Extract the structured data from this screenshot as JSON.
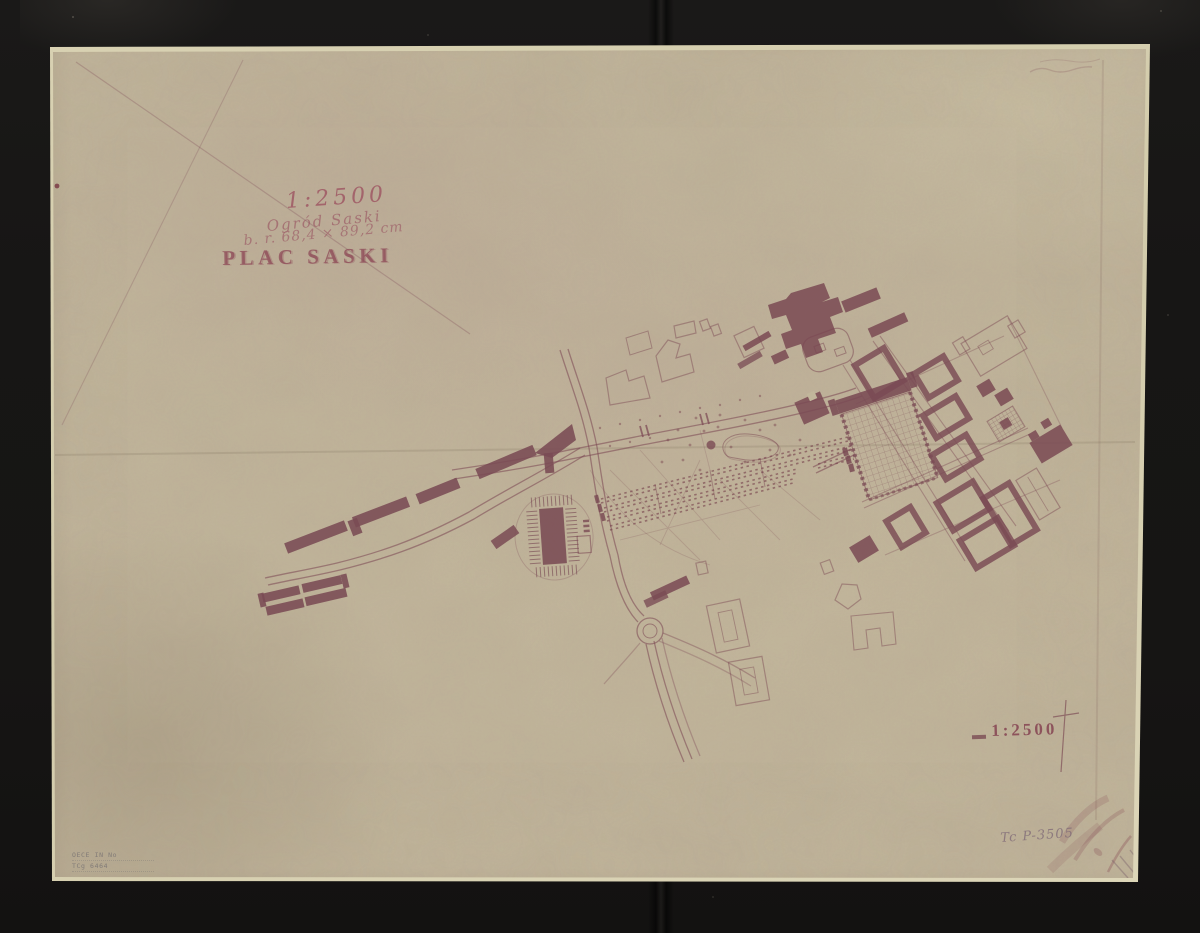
{
  "document": {
    "kind": "archival map scan",
    "subject": "Plan of Plac Saski and Ogród Saski (Saxon Square, Warsaw)"
  },
  "inscriptions": {
    "scale_note_handwritten": "1:2500",
    "subject_handwritten": "Ogród Saski",
    "size_note_handwritten": "b. r. 68,4 × 89,2 cm",
    "title_printed": "PLAC SASKI",
    "scale_printed": "1:2500",
    "inventory_number_pencil": "Tc P-3505",
    "stamp_line_1": "OECE IN No",
    "stamp_line_2": "TCg 6464"
  },
  "palette": {
    "background": "#161514",
    "paper": "#c1b69b",
    "paper_edge": "#d9d2b3",
    "ink_dark": "#7a4b54",
    "ink_faint": "#8d5a64",
    "pencil": "#7a6474"
  },
  "map_features": [
    "saxon-palace-complex",
    "parade-ground-grid",
    "city-blocks-district",
    "garden-alleys",
    "garden-pond",
    "fountain",
    "roundabout",
    "theatre-building",
    "western-building-row",
    "roads",
    "outlined-buildings"
  ]
}
